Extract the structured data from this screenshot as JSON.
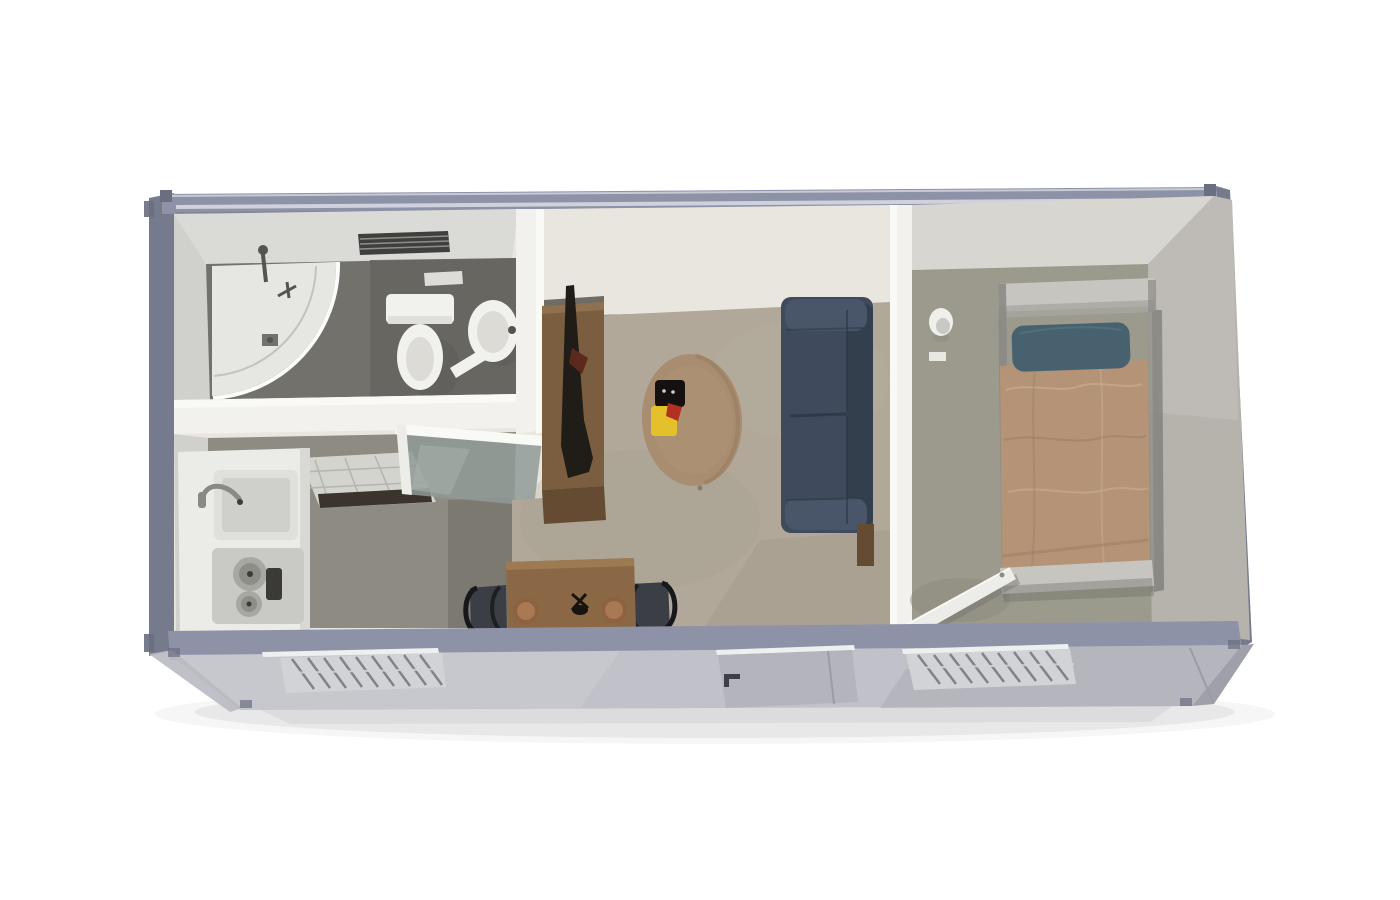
{
  "scene": {
    "description": "3D cutaway top-down render of a single-module container house floor plan on a white background",
    "background": "#ffffff"
  },
  "rooms": [
    {
      "name": "bathroom",
      "fixtures": [
        "corner-shower",
        "shower-fixture",
        "toilet",
        "wash-basin",
        "wall-vent",
        "wall-switch"
      ]
    },
    {
      "name": "kitchen",
      "fixtures": [
        "counter",
        "sink",
        "faucet",
        "two-burner-cooktop",
        "control-knob-panel",
        "glass-door",
        "floor-reflection"
      ]
    },
    {
      "name": "living-room",
      "fixtures": [
        "tv-cabinet",
        "tv",
        "oval-rug",
        "black-tray",
        "yellow-flowers",
        "sofa",
        "side-table",
        "dining-table",
        "dining-chair-left",
        "dining-chair-right",
        "plate-left",
        "plate-right",
        "centerpiece"
      ]
    },
    {
      "name": "bedroom",
      "fixtures": [
        "single-bed",
        "headboard",
        "pillow",
        "blanket",
        "footboard",
        "wall-lamp",
        "light-switch",
        "open-door"
      ]
    }
  ],
  "exterior": {
    "features": [
      "steel-frame-rails",
      "corner-castings",
      "front-facade",
      "louver-window-left",
      "entry-door",
      "door-handle",
      "louver-window-right",
      "ground-shadow"
    ]
  },
  "colors": {
    "background": "#ffffff",
    "frame": "#8d92a6",
    "frame_dark": "#757a8c",
    "frame_edge": "#696e80",
    "frame_highlight": "#d6d9e2",
    "side_panel": "#9fa0aa",
    "side_sliver": "#b9bac2",
    "facade": "#c1c1c9",
    "facade_light": "#cdcdd3",
    "facade_dark": "#a9a9b3",
    "trim_white": "#eef0f0",
    "window_frame": "#d2d3d7",
    "louver": "#6f6f77",
    "door_panel": "#b4b4bc",
    "door_frame_line": "#9b9ba5",
    "handle": "#3f3f47",
    "wall_white": "#f2f1ed",
    "wall_bright": "#f9f9f6",
    "wall_cream": "#e9e6e0",
    "wall_gray": "#dadad6",
    "wall_lean_left": "#d0d0cc",
    "wall_lean_gray": "#d8d6d1",
    "wall_right": "#b6b3ad",
    "wall_right_light": "#c2bfb9",
    "bathroom_floor": "#72716c",
    "bathroom_floor_dark": "#65645f",
    "kitchen_floor": "#8e8c82",
    "hall_dark": "#6f6d64",
    "threshold": "#3a342c",
    "living_floor": "#b1a899",
    "carpet_shade": "#a29a8a",
    "carpet_light": "#b8b09f",
    "bedroom_floor": "#9b9a8d",
    "bedroom_floor_dark": "#8b8a7e",
    "rug": "#a98d70",
    "rug_dark": "#96795c",
    "rug_light": "#b09377",
    "sofa": "#3f4b5d",
    "sofa_dark": "#343f4e",
    "sofa_light": "#49566a",
    "sofa_seam": "#2f3947",
    "tv_cabinet": "#7b5d3f",
    "tv_cabinet_light": "#8f7050",
    "tv_cabinet_front": "#654b31",
    "cabinet_shadow": "#3c362e",
    "tv": "#201d19",
    "tv_accent": "#5c291d",
    "table": "#8a6845",
    "table_light": "#9d7a52",
    "plate": "#8c6242",
    "plate_inner": "#a87952",
    "chair": "#3b3e44",
    "chair_frame": "#17181c",
    "bed_frame": "#c7c5c0",
    "bed_frame_dark": "#a8a6a0",
    "bed_rail": "#8b8a84",
    "bed_blanket": "#b49377",
    "blanket_light": "#c6ab8e",
    "blanket_dark": "#9c7e62",
    "bed_pillow": "#47626e",
    "pillow_light": "#567480",
    "bed_shadow": "#6e6d66",
    "fixture_white": "#f1f1ee",
    "fixture_inner": "#dddbd6",
    "fixture_shadow": "#55544f",
    "shower_tray": "#e6e6e2",
    "shower_rim": "#fbfbf9",
    "shower_arc": "#c2c2be",
    "vent": "#3f3f3d",
    "vent_slat": "#8e8e8a",
    "counter": "#ebebe7",
    "counter_edge": "#d8d8d4",
    "sink": "#dfdfdb",
    "sink_inner": "#cfcfcb",
    "faucet": "#8a8a85",
    "stove": "#c9c9c5",
    "burner": "#a8a8a3",
    "burner_inner": "#8e8e89",
    "knob": "#3b3a36",
    "glass": "#8f9a96",
    "glass_light": "#aab3ae",
    "reflection": "#dcdcd6",
    "grout": "#b5b5b0",
    "accent_yellow": "#e4c02a",
    "accent_red": "#b2301f",
    "baseboard": "#4b4036",
    "sconce": "#efefec",
    "sconce_inner": "#c9c9c3",
    "door_white": "#ecece8",
    "door_shadow": "#74746c",
    "shadow": "#cfcfcf",
    "shadow_soft": "#dddddd",
    "dark_item": "#141110",
    "utensil": "#17140f"
  }
}
